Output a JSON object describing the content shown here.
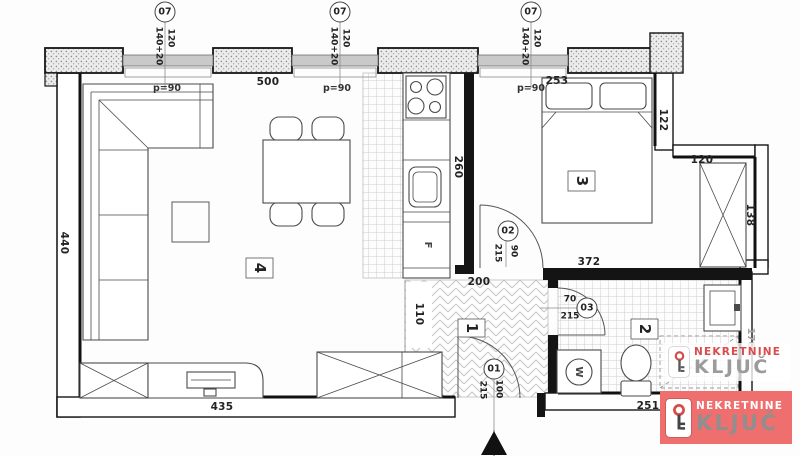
{
  "window_markers": [
    {
      "id": "07",
      "dim_a": "140+20",
      "dim_b": "120"
    },
    {
      "id": "07",
      "dim_a": "140+20",
      "dim_b": "120"
    },
    {
      "id": "07",
      "dim_a": "140+20",
      "dim_b": "120"
    }
  ],
  "parapet_labels": [
    "p=90",
    "p=90",
    "p=90"
  ],
  "doors": [
    {
      "id": "01",
      "width": "100",
      "height": "215"
    },
    {
      "id": "02",
      "width": "90",
      "height": "215"
    },
    {
      "id": "03",
      "width": "70",
      "height": "215"
    }
  ],
  "rooms": [
    {
      "number": "4"
    },
    {
      "number": "3"
    },
    {
      "number": "1"
    },
    {
      "number": "2"
    }
  ],
  "appliances": {
    "fridge": "F",
    "washing_machine": "W"
  },
  "dims": {
    "d500": "500",
    "d253": "253",
    "d122": "122",
    "d120": "120",
    "d138": "138",
    "d372": "372",
    "d440": "440",
    "d260": "260",
    "d200": "200",
    "d110": "110",
    "d435": "435",
    "d251": "251",
    "d170": "170"
  },
  "branding": {
    "watermark": {
      "line1": "NEKRETNINE",
      "line2": "KLJUČ"
    },
    "badge": {
      "line1": "NEKRETNINE",
      "line2": "KLJUČ"
    },
    "colors": {
      "accent_red": "#d94c4c",
      "badge_bg": "#ef6e6e",
      "kljuc_gray": "#8f8f8f",
      "wall_black": "#1b1b1b"
    }
  }
}
